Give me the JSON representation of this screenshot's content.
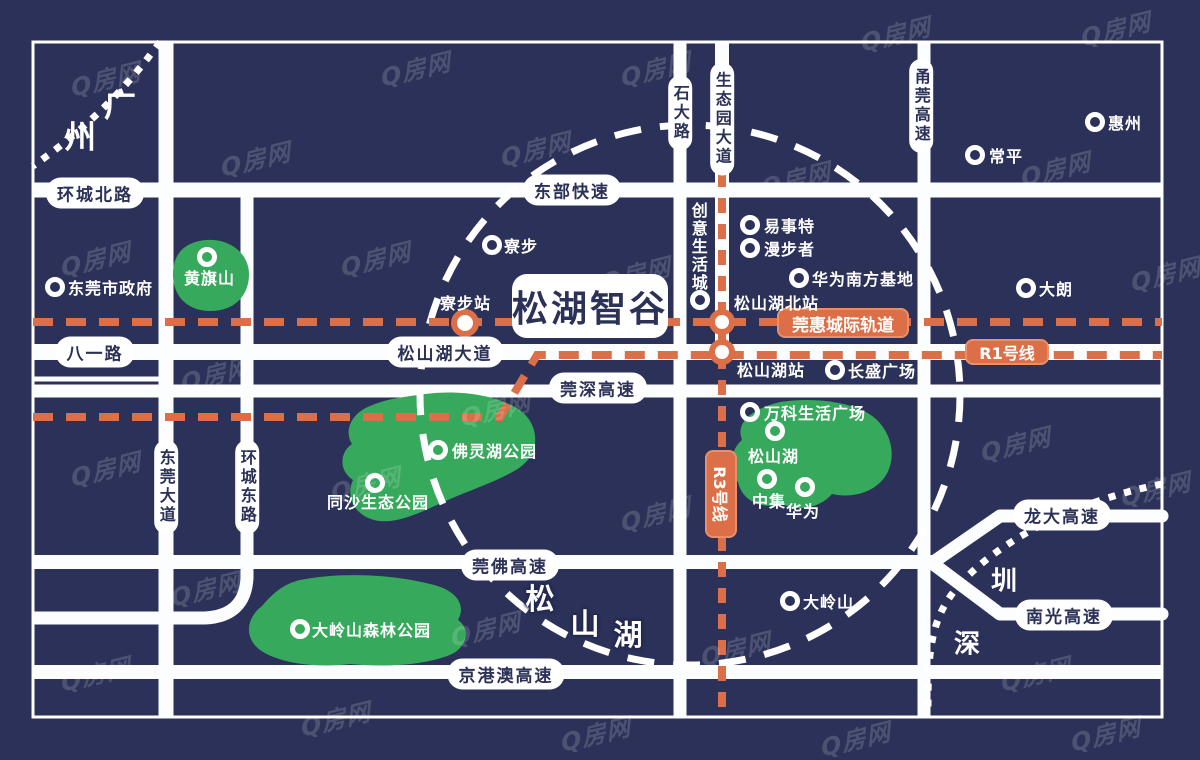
{
  "colors": {
    "background_navy": "#2b3158",
    "road_white": "#fcfdfe",
    "park_green": "#37a95c",
    "rail_orange": "#dc6f47",
    "pill_text_navy": "#2b3157"
  },
  "watermark": {
    "text": "Q房网"
  },
  "logo": {
    "text": "松湖智谷"
  },
  "road_labels": {
    "huancheng_north": "环城北路",
    "dongbu_express": "东部快速",
    "bayi_road": "八一路",
    "songshanhu_avenue": "松山湖大道",
    "guanshen_expressway": "莞深高速",
    "guanfo_expressway": "莞佛高速",
    "jinggangao_expressway": "京港澳高速",
    "longda_expressway": "龙大高速",
    "nanguang_expressway": "南光高速",
    "shida_road": "石大路",
    "shengtaiyuan_avenue": "生态园大道",
    "yongguan_expressway": "甬莞高速",
    "dongguan_avenue": "东莞大道",
    "huancheng_east": "环城东路"
  },
  "rail_labels": {
    "guanhui_intercity": "莞惠城际轨道",
    "r1_line": "R1号线",
    "r3_line": "R3号线"
  },
  "stations": {
    "liaobu_station": "寮步站",
    "songshanhu_north_station": "松山湖北站",
    "songshanhu_station": "松山湖站"
  },
  "pois": {
    "dongguan_government": "东莞市政府",
    "huangqishan": "黄旗山",
    "liaobu_town": "寮步",
    "chuangyi_life_city": "创意生活城",
    "yishite": "易事特",
    "manbuzhe": "漫步者",
    "huawei_south_base": "华为南方基地",
    "changping": "常平",
    "huizhou": "惠州",
    "dalang": "大朗",
    "changsheng_plaza": "长盛广场",
    "vanke_life_plaza": "万科生活广场",
    "songshanhu_lake": "松山湖",
    "zhongji": "中集",
    "huawei": "华为",
    "folinhu_park": "佛灵湖公园",
    "tongsha_eco_park": "同沙生态公园",
    "dalingshan_forest_park": "大岭山森林公园",
    "dalingshan": "大岭山"
  },
  "cities": {
    "guangzhou": [
      "广",
      "州"
    ],
    "shenzhen": [
      "圳",
      "深"
    ],
    "songshanhu_area": [
      "松",
      "山",
      "湖"
    ]
  }
}
